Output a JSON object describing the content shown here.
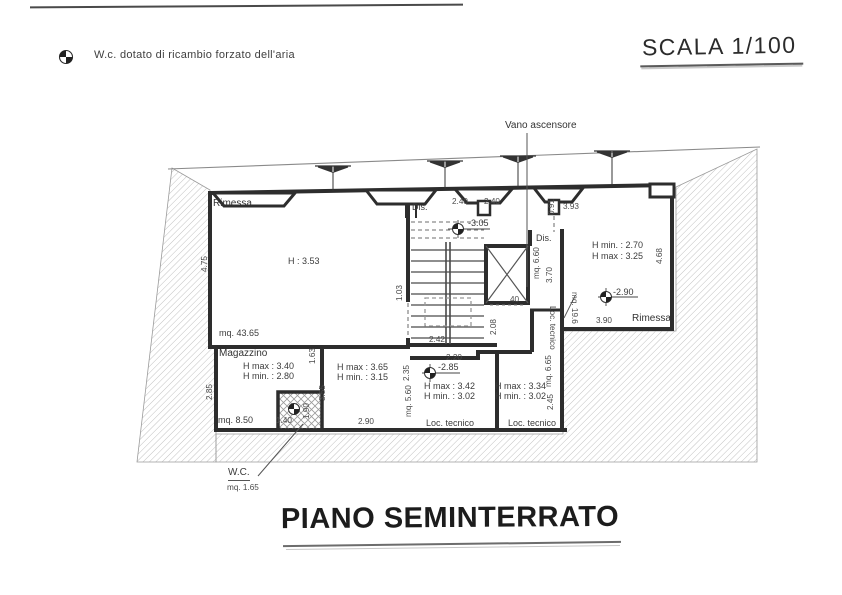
{
  "sheet": {
    "legend_note": "W.c. dotato di ricambio forzato dell'aria",
    "scale_label": "SCALA 1/100",
    "title": "PIANO SEMINTERRATO"
  },
  "callouts": {
    "elevator_shaft": "Vano ascensore",
    "wc_label": "W.C.",
    "wc_area": "mq. 1.65"
  },
  "rooms": {
    "rimessa_left": {
      "name": "Rimessa",
      "height": "H : 3.53",
      "area": "mq. 43.65"
    },
    "magazzino": {
      "name": "Magazzino",
      "h_max": "H max : 3.40",
      "h_min": "H min. : 2.80",
      "area": "mq. 8.50"
    },
    "room_center": {
      "h_max": "H max : 3.65",
      "h_min": "H min. : 3.15"
    },
    "dis_stairs": {
      "name": "Dis."
    },
    "dis_elevator": {
      "name": "Dis.",
      "area": "mq. 6.60"
    },
    "loc_tecnico_left": {
      "name": "Loc. tecnico",
      "h_max": "H max : 3.42",
      "h_min": "H min. : 3.02",
      "area": "mq. 5.60"
    },
    "loc_tecnico_right": {
      "name": "Loc. tecnico",
      "h_max": "H max : 3.34",
      "h_min": "H min. : 3.02"
    },
    "loc_tecnico_shaft": {
      "name": "Loc. tecnico",
      "area": "mq. 6.65"
    },
    "rimessa_right": {
      "name": "Rimessa",
      "h_min": "H min. : 2.70",
      "h_max": "H max : 3.25",
      "area": "mq. 19.6"
    }
  },
  "elevations": {
    "stairs_landing": "-3.05",
    "loc_tecnico_left": "-2.85",
    "rimessa_right": "-2.90"
  },
  "dimensions": {
    "rimessa_left_side": "4.75",
    "magazzino_side": "2.85",
    "opening_a": "1.63",
    "wc_width": "1.40",
    "wc_side": "1.90",
    "room_center_side": "3.55",
    "room_center_width": "2.90",
    "niche_left": "2.40",
    "niche_right": "2.40",
    "stairs_width": "2.42",
    "loc_left_width": "2.20",
    "loc_left_side": "2.35",
    "shaft_side": "2.08",
    "stairs_side": "1.03",
    "elevator_width": "40",
    "dis_elevator_side": "3.70",
    "door_right": "0.91",
    "rimessa_right_top": "3.93",
    "shaft_lower_side": "2.45",
    "rimessa_right_side": "4.68",
    "rimessa_right_width": "3.90"
  },
  "colors": {
    "ink": "#2d2d2d",
    "hatch": "#bdbdbd",
    "paper": "#ffffff"
  }
}
